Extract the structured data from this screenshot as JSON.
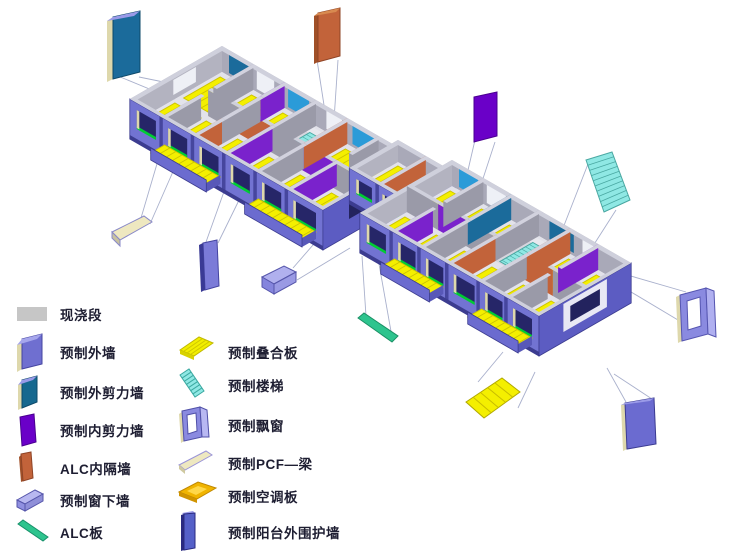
{
  "legend": {
    "left": [
      {
        "label": "现浇段",
        "color": "#c6c6c6"
      },
      {
        "label": "预制外墙",
        "color": "#6f6fd0"
      },
      {
        "label": "预制外剪力墙",
        "color": "#16688f"
      },
      {
        "label": "预制内剪力墙",
        "color": "#6a00c8"
      },
      {
        "label": "ALC内隔墙",
        "color": "#c2633a"
      },
      {
        "label": "预制窗下墙",
        "color": "#9090e0"
      },
      {
        "label": "ALC板",
        "color": "#2ec48e"
      }
    ],
    "right": [
      {
        "label": "预制叠合板",
        "color": "#f2ee00"
      },
      {
        "label": "预制楼梯",
        "color": "#8fe8e4"
      },
      {
        "label": "预制飘窗",
        "color": "#8a8ae0"
      },
      {
        "label": "预制PCF—梁",
        "color": "#eee8c0"
      },
      {
        "label": "预制空调板",
        "color": "#f0b400"
      },
      {
        "label": "预制阳台外围护墙",
        "color": "#5560c8"
      }
    ]
  },
  "model": {
    "callouts": [
      {
        "name": "callout-exterior-shear-wall"
      },
      {
        "name": "callout-alc-partition-wall"
      },
      {
        "name": "callout-interior-shear-wall"
      },
      {
        "name": "callout-stairs"
      },
      {
        "name": "callout-bay-window"
      },
      {
        "name": "callout-exterior-wall"
      },
      {
        "name": "callout-composite-slab"
      },
      {
        "name": "callout-alc-board"
      },
      {
        "name": "callout-window-sill-wall"
      },
      {
        "name": "callout-balcony-enclosure-wall"
      },
      {
        "name": "callout-pcf-beam"
      }
    ],
    "palette": {
      "facade": "#7273d2",
      "facade_dark": "#46469e",
      "footing": "#3c3c90",
      "wall_top": "#cfd0dc",
      "interior_gray": "#9a9aa8",
      "inner_purple": "#7a22cc",
      "alc_orange": "#c2633a",
      "shear_teal": "#1b6b9b",
      "light_blue": "#2b9bd8",
      "floor": "#e2e2ea",
      "slab_yellow": "#f4ef00",
      "slab_stripe": "#cdc400",
      "stair_cyan": "#8fe8e4",
      "stair_edge": "#4aa8a2",
      "green_strip": "#00cc33",
      "window_dark": "#262668",
      "cream": "#ded8ac",
      "leader": "#a9b0cc"
    }
  }
}
